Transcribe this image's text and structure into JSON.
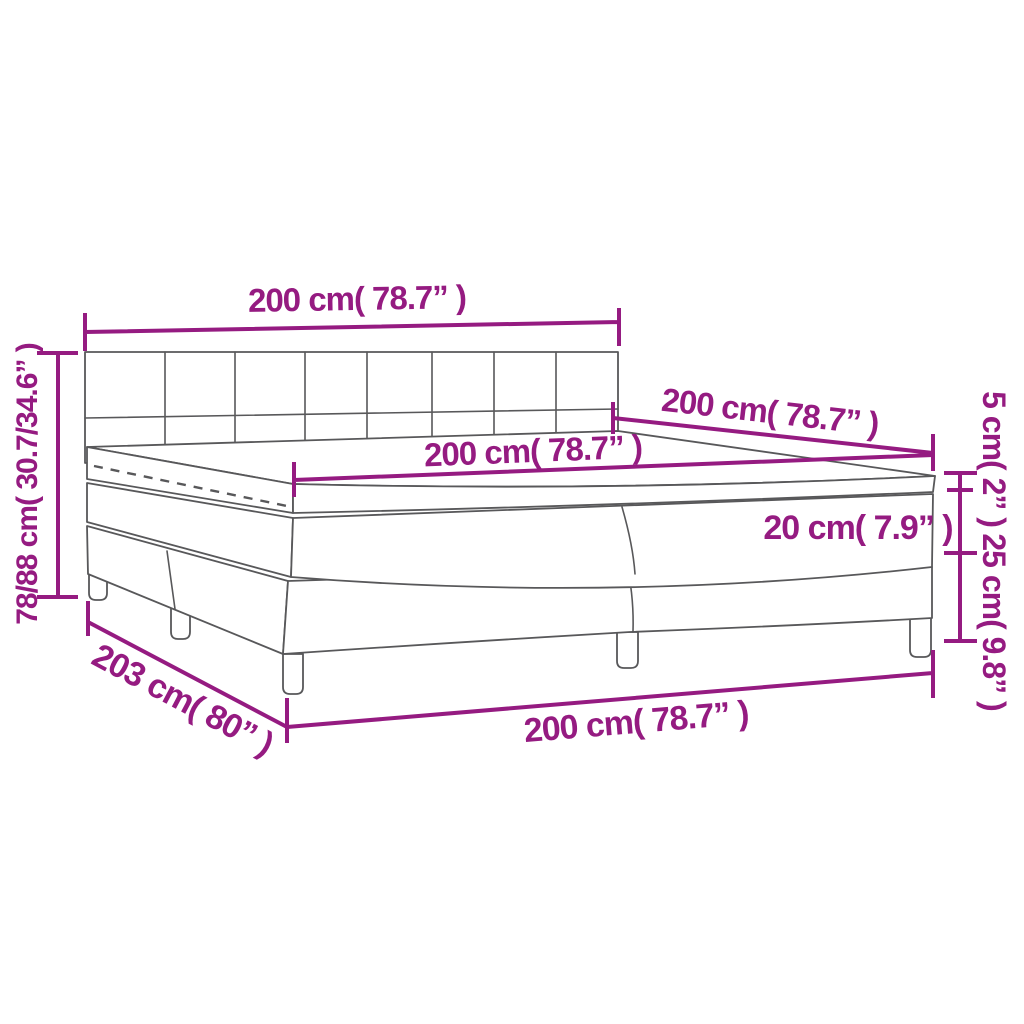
{
  "diagram": {
    "type": "product-dimension-diagram",
    "subject": "box spring bed with headboard, topper, mattress and split base",
    "colors": {
      "dimension": "#951b81",
      "outline": "#58585a",
      "background": "#ffffff"
    },
    "labels": {
      "headboard_width": "200 cm( 78.7” )",
      "height_range": "78/88 cm( 30.7/34.6” )",
      "length_top": "200 cm( 78.7” )",
      "mattress_width": "200 cm( 78.7” )",
      "topper_thickness": "5 cm( 2” )",
      "mattress_thickness": "20 cm( 7.9” )",
      "base_height": "25 cm( 9.8” )",
      "total_length": "203 cm( 80” )",
      "base_width": "200 cm( 78.7” )"
    }
  }
}
